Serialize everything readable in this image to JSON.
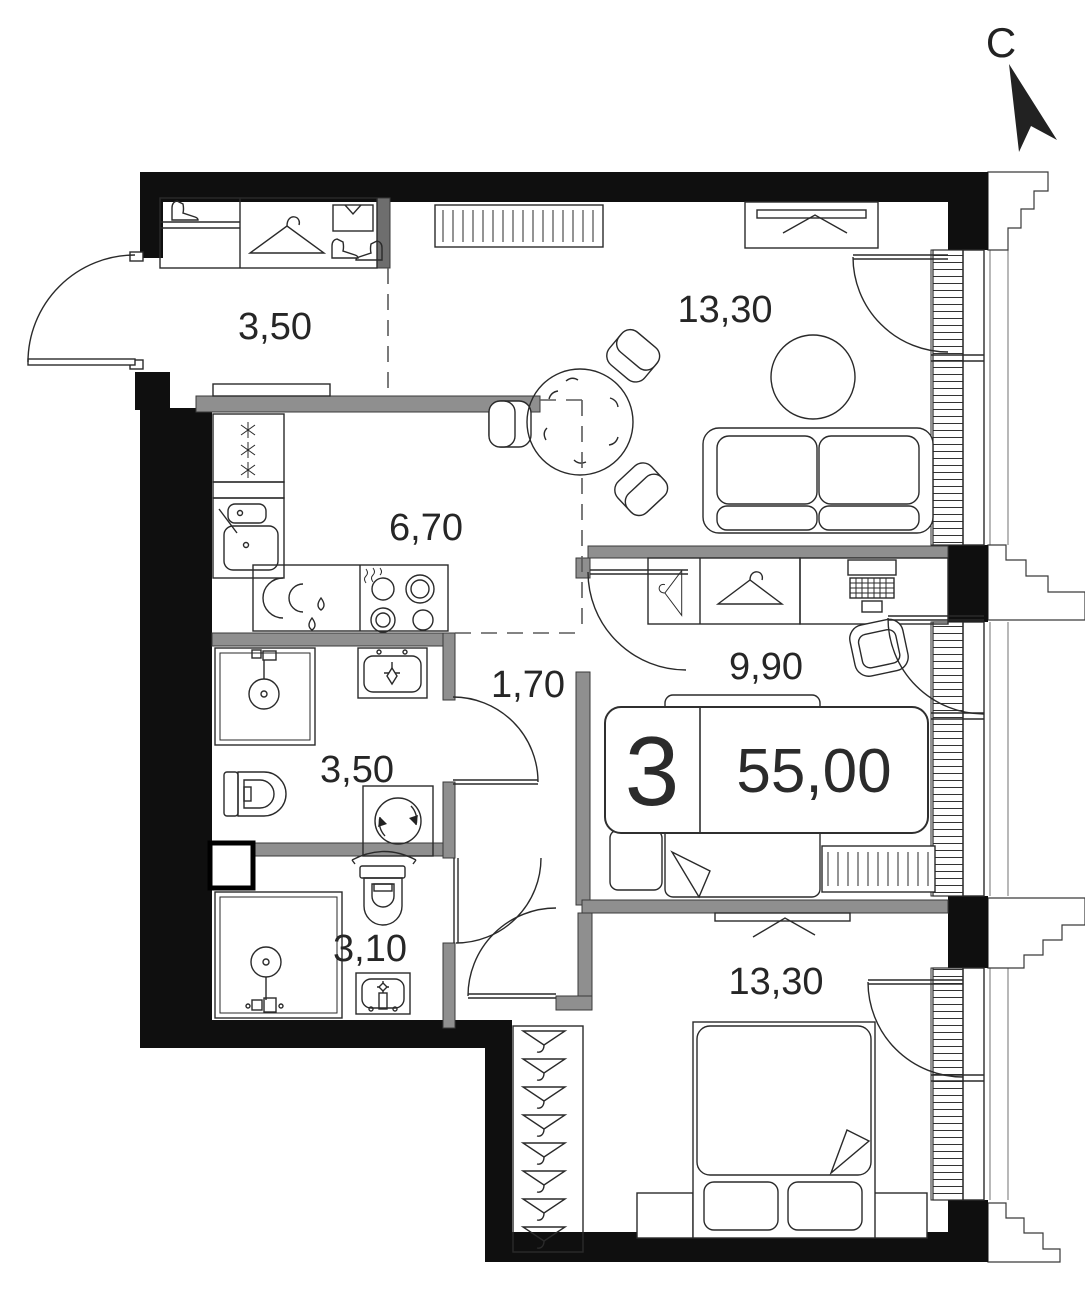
{
  "plan": {
    "compass": {
      "label": "С"
    },
    "info_badge": {
      "rooms_count": "3",
      "total_area": "55,00"
    },
    "rooms": [
      {
        "name": "hallway",
        "area": "3,50"
      },
      {
        "name": "living-room",
        "area": "13,30"
      },
      {
        "name": "kitchen",
        "area": "6,70"
      },
      {
        "name": "inner-corridor",
        "area": "1,70"
      },
      {
        "name": "bedroom",
        "area": "9,90"
      },
      {
        "name": "bathroom",
        "area": "3,50"
      },
      {
        "name": "shower-room",
        "area": "3,10"
      },
      {
        "name": "bedroom-2",
        "area": "13,30"
      }
    ]
  }
}
